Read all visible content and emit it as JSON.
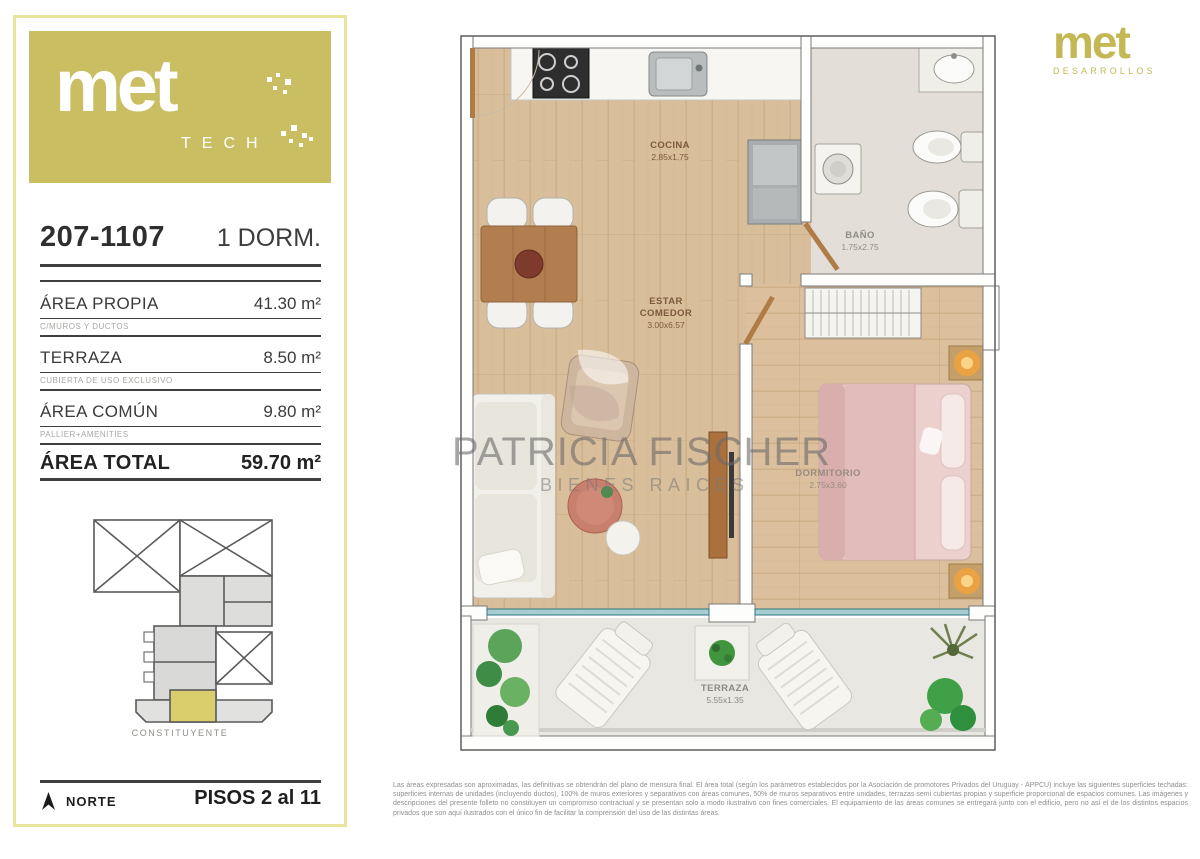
{
  "brand": {
    "tech_logo": {
      "word": "met",
      "sub": "TECH"
    },
    "dev_logo": {
      "word": "met",
      "sub": "DESARROLLOS"
    }
  },
  "unit": {
    "number": "207-1107",
    "type": "1 DORM."
  },
  "areas": {
    "rows": [
      {
        "label": "ÁREA PROPIA",
        "value": "41.30 m²",
        "note": "C/MUROS Y DUCTOS"
      },
      {
        "label": "TERRAZA",
        "value": "8.50 m²",
        "note": "CUBIERTA DE USO EXCLUSIVO"
      },
      {
        "label": "ÁREA COMÚN",
        "value": "9.80 m²",
        "note": "PALLIER+AMENITIES"
      }
    ],
    "total": {
      "label": "ÁREA TOTAL",
      "value": "59.70 m²"
    }
  },
  "keyplan": {
    "street_label": "CONSTITUYENTE"
  },
  "footer": {
    "north_label": "NORTE",
    "floors_label": "PISOS 2 al 11"
  },
  "plan_labels": {
    "cocina": {
      "name": "COCINA",
      "dims": "2.85x1.75"
    },
    "bano": {
      "name": "BAÑO",
      "dims": "1.75x2.75"
    },
    "estar": {
      "name": "ESTAR COMEDOR",
      "dims": "3.00x6.57"
    },
    "dormitorio": {
      "name": "DORMITORIO",
      "dims": "2.75x3.60"
    },
    "terraza": {
      "name": "TERRAZA",
      "dims": "5.55x1.35"
    }
  },
  "watermark": {
    "line1": "PATRICIA FISCHER",
    "line2": "BIENES RAICES"
  },
  "disclaimer": "Las áreas expresadas son aproximadas, las definitivas se obtendrán del plano de mensura final. El área total (según los parámetros establecidos por la Asociación de promotores Privados del Uruguay - APPCU) incluye las siguientes superficies techadas: superficies internas de unidades (incluyendo ductos), 100% de muros exteriores y separativos con áreas comunes, 50% de muros separativos entre unidades, terrazas semi cubiertas propias y superficie proporcional de espacios comunes. Las imágenes y descripciones del presente folleto no constituyen un compromiso contractual y se presentan solo a modo ilustrativo con fines comerciales. El equipamiento de las áreas comunes se entregará junto con el edificio, pero no así el de los distintos espacios privados que son aquí ilustrados con el único fin de facilitar la comprensión del uso de las distintas áreas."
}
